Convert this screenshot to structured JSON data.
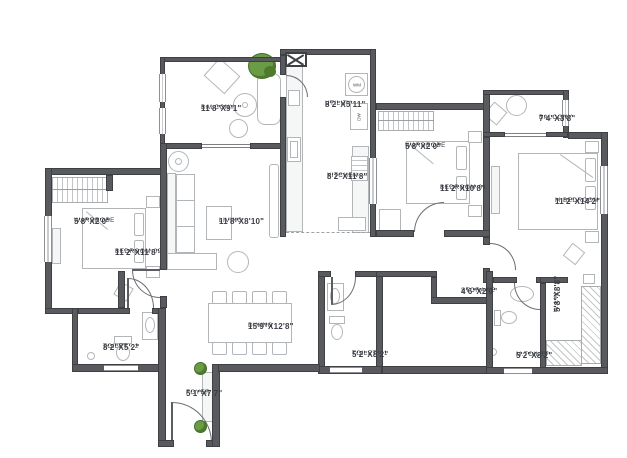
{
  "plan": {
    "canvas": {
      "width": 627,
      "height": 458
    },
    "colors": {
      "wall": "#595a5e",
      "wall_edge": "#3e4044",
      "furniture_line": "#b3b6b9",
      "text": "#3b3e44",
      "plant": "#6a9c45"
    },
    "rooms": [
      {
        "id": "balcony-top-left",
        "name": "BALCONY",
        "dims": "11'8\"X9'1\""
      },
      {
        "id": "utility",
        "name": "UTILITY",
        "dims": "8'2\"X5'11\""
      },
      {
        "id": "kitchen",
        "name": "KITCHEN",
        "dims": "8'2\"X11'8\""
      },
      {
        "id": "wardrobe-bed1",
        "name": "WARDROBE",
        "dims": "5'8\"X2'0\""
      },
      {
        "id": "bedroom-01",
        "name": "BEDROOM-01",
        "dims": "11'2\"X10'8\""
      },
      {
        "id": "balcony-top-right",
        "name": "BALCONY",
        "dims": "7'4\"X3'8\""
      },
      {
        "id": "master-bedroom",
        "name": "M.BEDROOM",
        "dims": "11'2\"X14'2\""
      },
      {
        "id": "wardrobe-bed2",
        "name": "WARDROBE",
        "dims": "5'8\"X2'0\""
      },
      {
        "id": "bedroom-02",
        "name": "BEDROOM-02",
        "dims": "11'2\"X11'8\""
      },
      {
        "id": "living",
        "name": "LIVING",
        "dims": "11'8\"X8'10\""
      },
      {
        "id": "toilet-2",
        "name": "TOILET - 2",
        "dims": "8'2\"X5'2\""
      },
      {
        "id": "dining",
        "name": "DINING",
        "dims": "15'9\"X12'8\""
      },
      {
        "id": "foyer",
        "name": "FOYER",
        "dims": "5'1\"X7'7\""
      },
      {
        "id": "toilet-1",
        "name": "TOILET - 1",
        "dims": "5'2\"X8'2\""
      },
      {
        "id": "storage",
        "name": "STORAGE",
        "dims": "4'6\"X2'0\""
      },
      {
        "id": "master-toilet",
        "name": "M.TOILET",
        "dims": "5'2\"X8'2\""
      },
      {
        "id": "walk-in-wardrobe",
        "name": "W.I.W.",
        "dims": "5'8\"X8'8\""
      }
    ],
    "appliances": {
      "washing_machine": "WM",
      "dishwasher": "DW"
    }
  }
}
